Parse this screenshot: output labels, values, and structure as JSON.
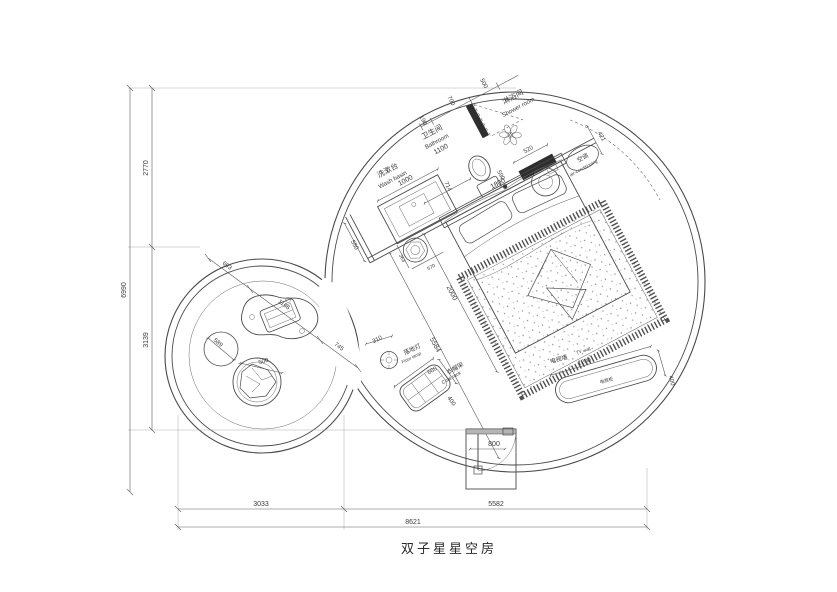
{
  "title": "双子星星空房",
  "rooms": {
    "washbasin": {
      "cn": "洗漱台",
      "en": "Wash basin"
    },
    "bathroom": {
      "cn": "卫生间",
      "en": "Bathroom"
    },
    "shower": {
      "cn": "淋浴间",
      "en": "Shower room"
    },
    "ac": {
      "cn": "空调",
      "en": "air-conditioning"
    },
    "floor_lamp": {
      "cn": "落地灯",
      "en": "Floor lamp"
    },
    "coat_rack": {
      "cn": "衣帽架",
      "en": "Coat rack"
    },
    "tv_wall": {
      "cn": "电视墙",
      "en": "TV wall"
    },
    "tv_cabinet": {
      "cn": "电视柜"
    }
  },
  "dims": {
    "left_total": "6990",
    "left_upper": "2770",
    "left_lower": "3139",
    "bottom_left": "3033",
    "bottom_right": "5582",
    "bottom_total": "8621",
    "washbasin_len": "1000",
    "bathroom_len": "1100",
    "wall_stub": "190",
    "bath_door": "700",
    "shower_len": "500",
    "shower_screen": "590",
    "ac_len": "520",
    "ac_depth": "421",
    "toilet_gap": "714",
    "counter_depth": "550",
    "bed_width": "1800",
    "bed_length": "2000",
    "stool_a": "363",
    "stool_b": "570",
    "room_diag": "5584",
    "lamp": "310",
    "coat_len": "660",
    "coat_depth": "400",
    "tv_len": "1200",
    "tv_depth": "400",
    "door_width": "800",
    "round_a": "693",
    "round_b": "1166",
    "round_c": "745",
    "round_rug": "589",
    "lounge_chair": "500"
  },
  "colors": {
    "line": "#4a4a4a",
    "wall": "#2e2e2e",
    "background": "#ffffff"
  }
}
